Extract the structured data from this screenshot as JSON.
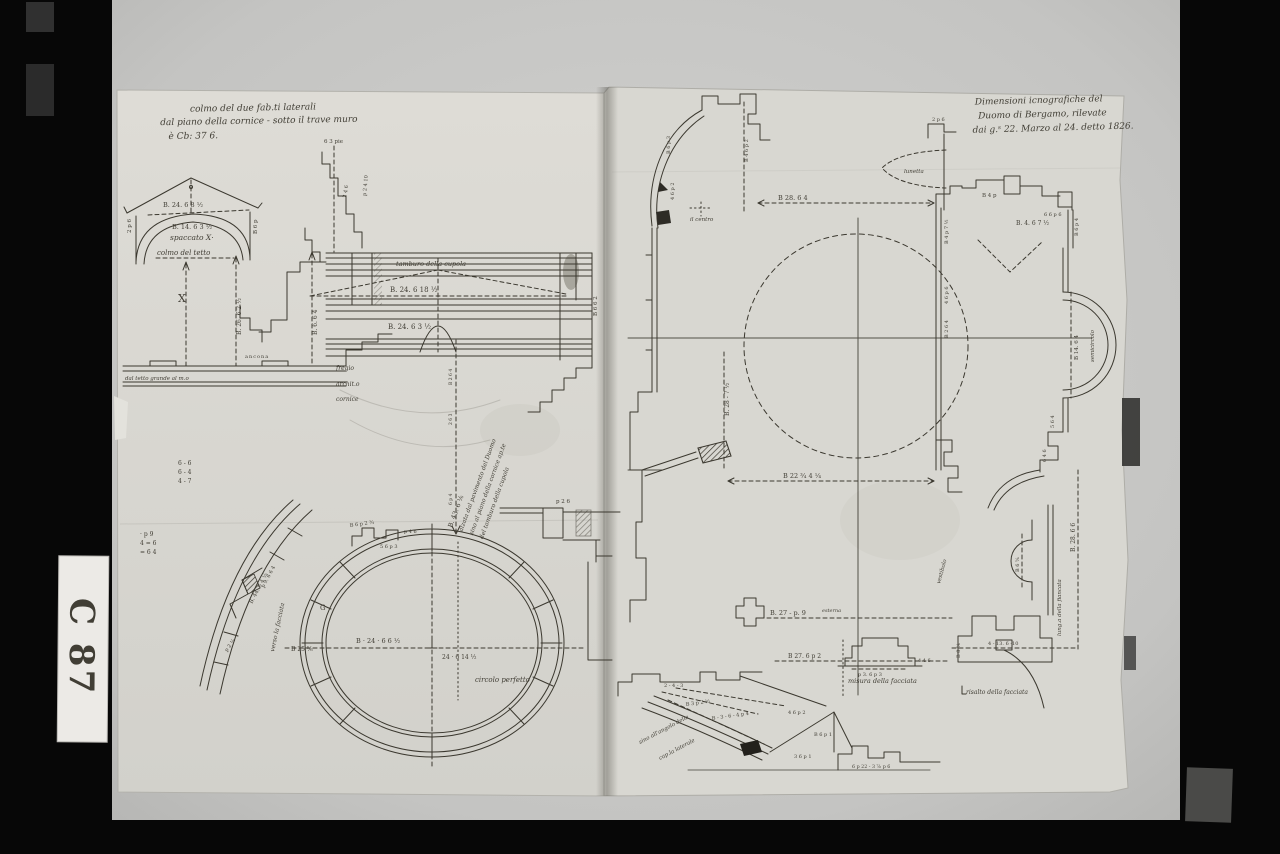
{
  "film": {
    "label": "C 87"
  },
  "left": {
    "ins1": "colmo del due fab.ti laterali",
    "ins2": "dal piano della cornice - sotto il trave muro",
    "ins3": "è Cb: 37 6.",
    "ped_top": "B. 24. 6 8 ½",
    "ped_arch": "B. 14. 6 3 ½",
    "ped_l": "2 p 6",
    "ped_r": "B 6 p",
    "spaccato": "spaccato X·",
    "colmo": "colmo del tetto",
    "x": "X",
    "col1": "B. 26. 6 2 ½",
    "col2": "B. 6. 6 4",
    "base_note": "dal tetto grande al m.o",
    "ancona": "ancona",
    "st1": "6 3 pie",
    "st2": "2 4 6",
    "st3": "p 2 4 10",
    "tamburo": "tamburo della cupola",
    "ent1": "B. 24. 6 18 ½",
    "ent2": "B. 24. 6 3 ½",
    "ent_side": "B 6 6 2",
    "p1": "fregio",
    "p2": "archit.o",
    "p3": "cornice",
    "h1": "B. 43. 6 ⅙",
    "h2": "alzata dal pavimento del Duomo",
    "h3": "sino al piano della cornice ap.te",
    "h4": "del tamburo della cupola",
    "t1": "B 2 6 4",
    "t2": "2 6 3",
    "t3": "6 p 4",
    "f1a": "6 - 6",
    "f1b": "6 - 4",
    "f1c": "4 - 7",
    "f2a": "· p 9",
    "f2b": "4 = 6",
    "f2c": "= 6 4",
    "ov_l": "B 25 ⅚",
    "ov_m": "B · 24 · 6 6 ½",
    "ov_r": "24 · 6 14 ½",
    "ov_cap": "circolo perfetto",
    "ov_g": "G",
    "ov_t1": "B 6 p 2 ¾",
    "ov_t2": "5 6 p 3",
    "ov_t3": "p 4 6",
    "arc1": "B. 44. 6 4 ½",
    "arc2": "p 9. 6 6 4",
    "arc3": "p 2 ¼",
    "verso": "verso la facciata",
    "wall1": "p 2 6"
  },
  "right": {
    "ins1": "Dimensioni icnografiche del",
    "ins2": "Duomo di Bergamo, rilevate",
    "ins3": "dai g.ˢ 22. Marzo al 24. detto 1826.",
    "centro": "il centro",
    "lunetta": "lunetta",
    "dtop": "B 28. 6 4",
    "dmid": "B 22 ¾ 4 ¼",
    "dleft": "B. 28 - 7 ½",
    "semic": "semicircolo",
    "dapse": "B 14. 6 4",
    "dright": "B. 28. 6 6",
    "fianc": "lung.a della fiancata",
    "vest": "vestibolo",
    "niche": "B 6 ⅚",
    "tl1": "B 6 p 3",
    "tl2": "4 6 p 2",
    "tl3": "2 p 6",
    "tl4": "B 4 6 p 2",
    "tr1": "B 4 p",
    "tr2": "B. 4. 6 7 ½",
    "tr3": "6 6 p 6",
    "tr4": "B 6 p 4",
    "r1": "B 4 p 7 ½",
    "r2": "4 6 p 6",
    "r3": "B 2 6 4",
    "r4": "5 6 4",
    "r5": "6 4 6",
    "b1": "B. 27 - p. 9",
    "b1a": "esterna",
    "b2": "B 27. 6 p 2",
    "b3": "p 3. 6 p 3",
    "b4": "4 4 6",
    "b5": "4 - 13. 6 -10",
    "b6": "B 8 ⅚",
    "facc": "misura della facciata",
    "ris": "risalto della facciata",
    "s1": "2 - 4 - 3",
    "s2": "B 3 p 2 ½",
    "s3": "B - 3 - 6 - 4 p 4",
    "s4": "4 6 p 2",
    "s5": "B 6 p 1",
    "s6": "3 6 p 1",
    "s7": "6 p 22 - 3 ⅞ p 6",
    "n1": "sino all'angolo della",
    "n2": "cap.la laterale"
  }
}
